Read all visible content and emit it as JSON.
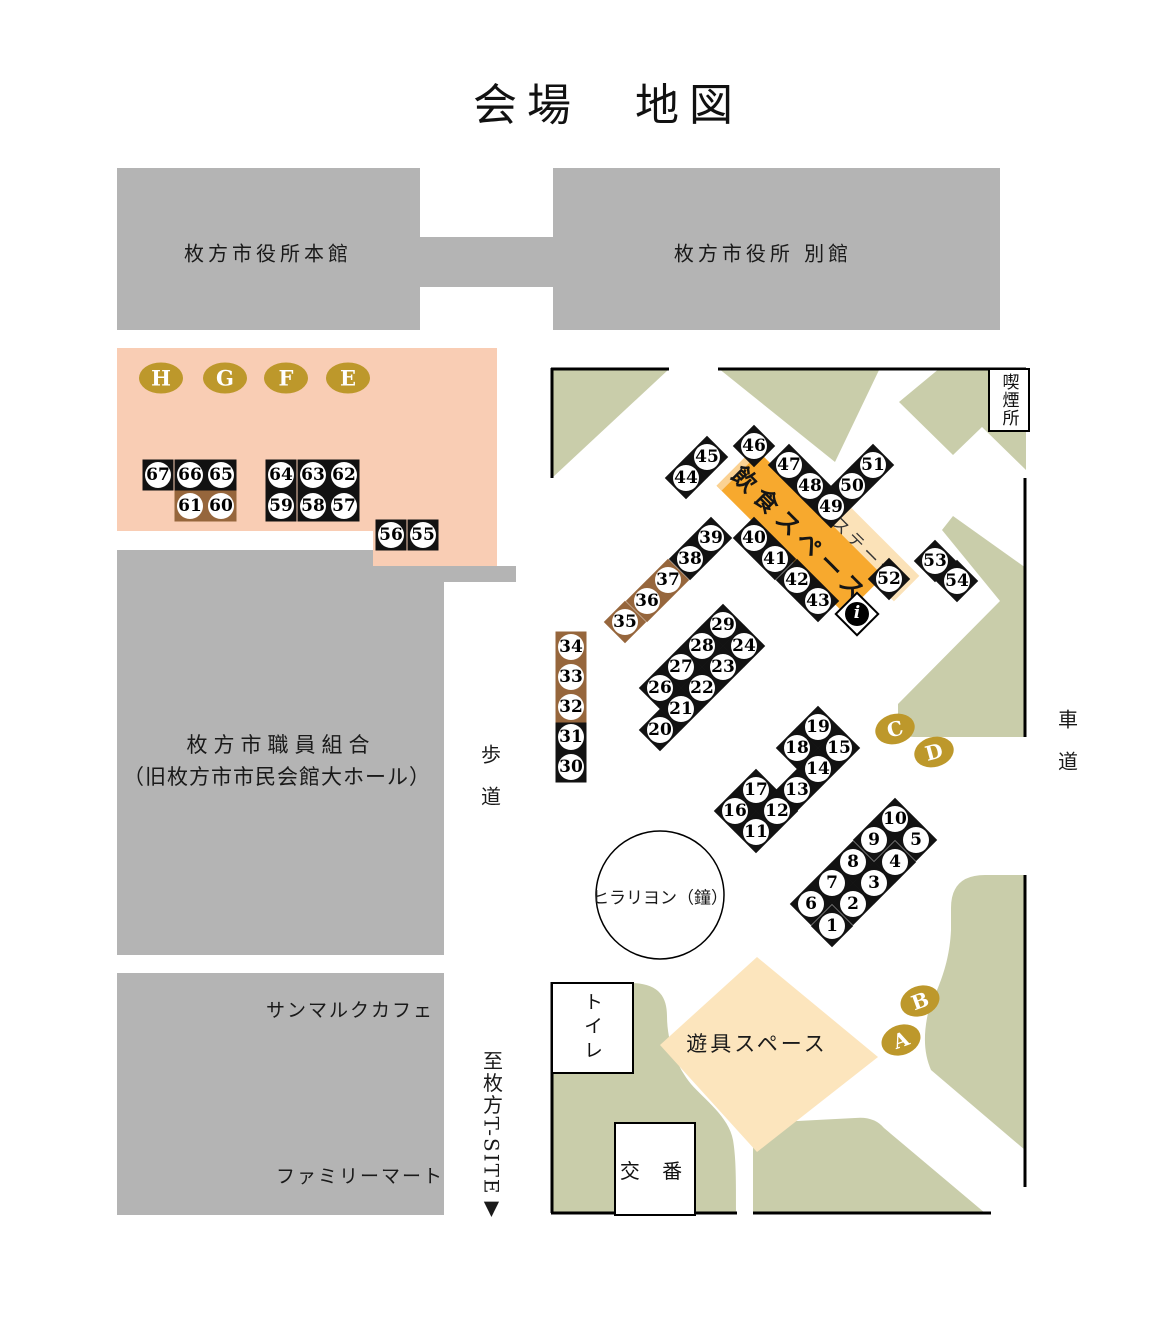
{
  "title": "会場　地図",
  "colors": {
    "building_gray": "#B4B4B4",
    "zone_pink": "#F9CDB4",
    "park_green": "#C9CDAA",
    "badge_gold": "#BD982B",
    "booth_brown": "#96663C",
    "booth_black": "#121212",
    "eat_orange": "#F7A92E",
    "eat_orange_light": "#FBD293",
    "stage_cream": "#FBE2B8",
    "playground_cream": "#FCE5BD"
  },
  "banner": {
    "label": "飲食スペース"
  },
  "stage": {
    "label": "ステージ"
  },
  "info": {
    "glyph": "i"
  },
  "labels": [
    {
      "id": "bldg-honkan-label",
      "t": "枚方市役所本館",
      "x": 268,
      "y": 252,
      "s": 20,
      "ls": 4,
      "v": 0
    },
    {
      "id": "bldg-bekkan-label",
      "t": "枚方市役所 別館",
      "x": 763,
      "y": 252,
      "s": 20,
      "ls": 4,
      "v": 0
    },
    {
      "id": "bldg-kumiai-label-line1",
      "t": "枚方市職員組合",
      "x": 281,
      "y": 744,
      "s": 21,
      "ls": 6,
      "v": 0
    },
    {
      "id": "bldg-kumiai-label-line2",
      "t": "（旧枚方市市民会館大ホール）",
      "x": 277,
      "y": 776,
      "s": 21,
      "ls": 1,
      "v": 0
    },
    {
      "id": "bldg-sanmarc-label",
      "t": "サンマルクカフェ",
      "x": 350,
      "y": 1009,
      "s": 19,
      "ls": 2,
      "v": 0
    },
    {
      "id": "bldg-familymart-label",
      "t": "ファミリーマート",
      "x": 360,
      "y": 1175,
      "s": 19,
      "ls": 2,
      "v": 0
    },
    {
      "id": "hodou-label",
      "t": "歩道",
      "x": 490,
      "y": 786,
      "s": 20,
      "ls": 22,
      "v": 1
    },
    {
      "id": "shadou-label",
      "t": "車道",
      "x": 1067,
      "y": 751,
      "s": 20,
      "ls": 22,
      "v": 1
    },
    {
      "id": "tsite-label",
      "t": "至枚方T-SITE▼",
      "x": 492,
      "y": 1136,
      "s": 20,
      "ls": 2,
      "v": 1
    },
    {
      "id": "yuugu-label",
      "t": "遊具スペース",
      "x": 757,
      "y": 1043,
      "s": 21,
      "ls": 3,
      "v": 0
    },
    {
      "id": "bell-label",
      "t": "ヒラリヨン（鐘）",
      "x": 660,
      "y": 896,
      "s": 17,
      "ls": 0,
      "v": 0
    }
  ],
  "boxes": [
    {
      "id": "kitsuenjo-box",
      "t": "喫煙所",
      "x": 988,
      "y": 368,
      "w": 38,
      "h": 60,
      "v": 1,
      "s": 17,
      "ls": 1
    },
    {
      "id": "toilet-box",
      "t": "トイレ",
      "x": 551,
      "y": 982,
      "w": 79,
      "h": 88,
      "v": 1,
      "s": 19,
      "ls": 5
    },
    {
      "id": "kouban-box",
      "t": "交 番",
      "x": 614,
      "y": 1122,
      "w": 78,
      "h": 90,
      "v": 0,
      "s": 20,
      "ls": 8
    }
  ],
  "letters": [
    {
      "ch": "H",
      "x": 161,
      "y": 378,
      "w": 44,
      "h": 31,
      "fs": 21,
      "rot": 0
    },
    {
      "ch": "G",
      "x": 225,
      "y": 378,
      "w": 44,
      "h": 31,
      "fs": 21,
      "rot": 0
    },
    {
      "ch": "F",
      "x": 286,
      "y": 378,
      "w": 44,
      "h": 31,
      "fs": 21,
      "rot": 0
    },
    {
      "ch": "E",
      "x": 348,
      "y": 378,
      "w": 44,
      "h": 31,
      "fs": 21,
      "rot": 0
    },
    {
      "ch": "C",
      "x": 895,
      "y": 729,
      "w": 40,
      "h": 30,
      "fs": 20,
      "rot": -15
    },
    {
      "ch": "D",
      "x": 934,
      "y": 752,
      "w": 40,
      "h": 30,
      "fs": 20,
      "rot": -15
    },
    {
      "ch": "B",
      "x": 920,
      "y": 1001,
      "w": 40,
      "h": 30,
      "fs": 20,
      "rot": -20
    },
    {
      "ch": "A",
      "x": 901,
      "y": 1040,
      "w": 40,
      "h": 30,
      "fs": 20,
      "rot": -20
    }
  ],
  "booths": [
    {
      "n": "1",
      "s": "d",
      "c": "k",
      "x": 832,
      "y": 926
    },
    {
      "n": "2",
      "s": "d",
      "c": "k",
      "x": 853,
      "y": 904
    },
    {
      "n": "3",
      "s": "d",
      "c": "k",
      "x": 874,
      "y": 883
    },
    {
      "n": "4",
      "s": "d",
      "c": "k",
      "x": 895,
      "y": 862
    },
    {
      "n": "5",
      "s": "d",
      "c": "k",
      "x": 916,
      "y": 840
    },
    {
      "n": "6",
      "s": "d",
      "c": "k",
      "x": 811,
      "y": 904
    },
    {
      "n": "7",
      "s": "d",
      "c": "k",
      "x": 832,
      "y": 883
    },
    {
      "n": "8",
      "s": "d",
      "c": "k",
      "x": 853,
      "y": 862
    },
    {
      "n": "9",
      "s": "d",
      "c": "k",
      "x": 874,
      "y": 840
    },
    {
      "n": "10",
      "s": "d",
      "c": "k",
      "x": 895,
      "y": 819
    },
    {
      "n": "11",
      "s": "d",
      "c": "k",
      "x": 756,
      "y": 832
    },
    {
      "n": "12",
      "s": "d",
      "c": "k",
      "x": 777,
      "y": 811
    },
    {
      "n": "13",
      "s": "d",
      "c": "k",
      "x": 797,
      "y": 790
    },
    {
      "n": "14",
      "s": "d",
      "c": "k",
      "x": 818,
      "y": 769
    },
    {
      "n": "15",
      "s": "d",
      "c": "k",
      "x": 839,
      "y": 748
    },
    {
      "n": "16",
      "s": "d",
      "c": "k",
      "x": 735,
      "y": 811
    },
    {
      "n": "17",
      "s": "d",
      "c": "k",
      "x": 756,
      "y": 790
    },
    {
      "n": "18",
      "s": "d",
      "c": "k",
      "x": 797,
      "y": 748
    },
    {
      "n": "19",
      "s": "d",
      "c": "k",
      "x": 818,
      "y": 727
    },
    {
      "n": "20",
      "s": "d",
      "c": "k",
      "x": 660,
      "y": 730
    },
    {
      "n": "21",
      "s": "d",
      "c": "k",
      "x": 681,
      "y": 709
    },
    {
      "n": "22",
      "s": "d",
      "c": "k",
      "x": 702,
      "y": 688
    },
    {
      "n": "23",
      "s": "d",
      "c": "k",
      "x": 723,
      "y": 667
    },
    {
      "n": "24",
      "s": "d",
      "c": "k",
      "x": 744,
      "y": 646
    },
    {
      "n": "26",
      "s": "d",
      "c": "k",
      "x": 660,
      "y": 688
    },
    {
      "n": "27",
      "s": "d",
      "c": "k",
      "x": 681,
      "y": 667
    },
    {
      "n": "28",
      "s": "d",
      "c": "k",
      "x": 702,
      "y": 646
    },
    {
      "n": "29",
      "s": "d",
      "c": "k",
      "x": 723,
      "y": 625
    },
    {
      "n": "30",
      "s": "q",
      "c": "k",
      "x": 571,
      "y": 767
    },
    {
      "n": "31",
      "s": "q",
      "c": "k",
      "x": 571,
      "y": 737
    },
    {
      "n": "32",
      "s": "q",
      "c": "b",
      "x": 571,
      "y": 707
    },
    {
      "n": "33",
      "s": "q",
      "c": "b",
      "x": 571,
      "y": 677
    },
    {
      "n": "34",
      "s": "q",
      "c": "b",
      "x": 571,
      "y": 647
    },
    {
      "n": "35",
      "s": "d",
      "c": "b",
      "x": 625,
      "y": 622
    },
    {
      "n": "36",
      "s": "d",
      "c": "b",
      "x": 647,
      "y": 601
    },
    {
      "n": "37",
      "s": "d",
      "c": "b",
      "x": 668,
      "y": 580
    },
    {
      "n": "38",
      "s": "d",
      "c": "k",
      "x": 690,
      "y": 559
    },
    {
      "n": "39",
      "s": "d",
      "c": "k",
      "x": 711,
      "y": 538
    },
    {
      "n": "40",
      "s": "d",
      "c": "k",
      "x": 754,
      "y": 538
    },
    {
      "n": "41",
      "s": "d",
      "c": "k",
      "x": 775,
      "y": 559
    },
    {
      "n": "42",
      "s": "d",
      "c": "k",
      "x": 797,
      "y": 580
    },
    {
      "n": "43",
      "s": "d",
      "c": "k",
      "x": 818,
      "y": 601
    },
    {
      "n": "44",
      "s": "d",
      "c": "k",
      "x": 686,
      "y": 478
    },
    {
      "n": "45",
      "s": "d",
      "c": "k",
      "x": 707,
      "y": 457
    },
    {
      "n": "46",
      "s": "d",
      "c": "k",
      "x": 754,
      "y": 446
    },
    {
      "n": "47",
      "s": "d",
      "c": "k",
      "x": 789,
      "y": 465
    },
    {
      "n": "48",
      "s": "d",
      "c": "k",
      "x": 810,
      "y": 486
    },
    {
      "n": "49",
      "s": "d",
      "c": "k",
      "x": 831,
      "y": 507
    },
    {
      "n": "50",
      "s": "d",
      "c": "k",
      "x": 852,
      "y": 486
    },
    {
      "n": "51",
      "s": "d",
      "c": "k",
      "x": 873,
      "y": 465
    },
    {
      "n": "52",
      "s": "d",
      "c": "k",
      "x": 889,
      "y": 579
    },
    {
      "n": "53",
      "s": "d",
      "c": "k",
      "x": 935,
      "y": 561
    },
    {
      "n": "54",
      "s": "d",
      "c": "k",
      "x": 957,
      "y": 581
    },
    {
      "n": "55",
      "s": "q",
      "c": "k",
      "x": 423,
      "y": 535
    },
    {
      "n": "56",
      "s": "q",
      "c": "k",
      "x": 391,
      "y": 535
    },
    {
      "n": "57",
      "s": "q",
      "c": "k",
      "x": 344,
      "y": 506
    },
    {
      "n": "58",
      "s": "q",
      "c": "k",
      "x": 313,
      "y": 506
    },
    {
      "n": "59",
      "s": "q",
      "c": "k",
      "x": 281,
      "y": 506
    },
    {
      "n": "60",
      "s": "q",
      "c": "b",
      "x": 221,
      "y": 506
    },
    {
      "n": "61",
      "s": "q",
      "c": "b",
      "x": 190,
      "y": 506
    },
    {
      "n": "62",
      "s": "q",
      "c": "k",
      "x": 344,
      "y": 475
    },
    {
      "n": "63",
      "s": "q",
      "c": "k",
      "x": 313,
      "y": 475
    },
    {
      "n": "64",
      "s": "q",
      "c": "k",
      "x": 281,
      "y": 475
    },
    {
      "n": "65",
      "s": "q",
      "c": "k",
      "x": 221,
      "y": 475
    },
    {
      "n": "66",
      "s": "q",
      "c": "k",
      "x": 190,
      "y": 475
    },
    {
      "n": "67",
      "s": "q",
      "c": "k",
      "x": 158,
      "y": 475
    }
  ]
}
